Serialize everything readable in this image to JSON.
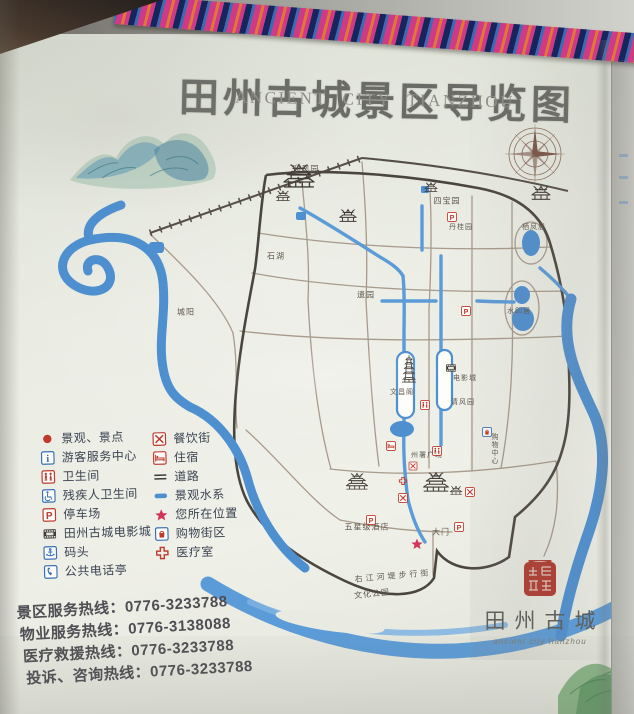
{
  "title": {
    "cn": "田州古城景区导览图",
    "en": "ANCIENT CITY TIANZHOU"
  },
  "seal": {
    "name": "田州古城",
    "script": "ancient city tianzhou"
  },
  "legend": {
    "left": [
      {
        "icon": "spot-dot",
        "label": "景观、景点"
      },
      {
        "icon": "info",
        "label": "游客服务中心"
      },
      {
        "icon": "toilet",
        "label": "卫生间"
      },
      {
        "icon": "accessible-toilet",
        "label": "残疾人卫生间"
      },
      {
        "icon": "parking",
        "label": "停车场"
      },
      {
        "icon": "cinema",
        "label": "田州古城电影城"
      },
      {
        "icon": "dock",
        "label": "码头"
      },
      {
        "icon": "phone",
        "label": "公共电话亭"
      }
    ],
    "right": [
      {
        "icon": "dining",
        "label": "餐饮街"
      },
      {
        "icon": "lodging",
        "label": "住宿"
      },
      {
        "icon": "road",
        "label": "道路"
      },
      {
        "icon": "water",
        "label": "景观水系"
      },
      {
        "icon": "star",
        "label": "您所在位置"
      },
      {
        "icon": "shopping",
        "label": "购物街区"
      },
      {
        "icon": "medical",
        "label": "医疗室"
      }
    ]
  },
  "hotlines": [
    {
      "label": "景区服务热线",
      "number": "0776-3233788"
    },
    {
      "label": "物业服务热线",
      "number": "0776-3138088"
    },
    {
      "label": "医疗救援热线",
      "number": "0776-3233788"
    },
    {
      "label": "投诉、咨询热线",
      "number": "0776-3233788"
    }
  ],
  "map": {
    "labels": [
      {
        "text": "迎凤园",
        "x": 306,
        "y": 169,
        "s": 8
      },
      {
        "text": "四宝园",
        "x": 447,
        "y": 201,
        "s": 8
      },
      {
        "text": "丹桂园",
        "x": 461,
        "y": 227,
        "s": 7
      },
      {
        "text": "栖凤居",
        "x": 534,
        "y": 227,
        "s": 7
      },
      {
        "text": "石湖",
        "x": 276,
        "y": 256,
        "s": 8
      },
      {
        "text": "遗园",
        "x": 366,
        "y": 295,
        "s": 8
      },
      {
        "text": "城阳",
        "x": 186,
        "y": 312,
        "s": 8
      },
      {
        "text": "水印居",
        "x": 519,
        "y": 311,
        "s": 7
      },
      {
        "text": "文昌阁",
        "x": 402,
        "y": 392,
        "s": 7
      },
      {
        "text": "电影城",
        "x": 465,
        "y": 378,
        "s": 7
      },
      {
        "text": "清风园",
        "x": 463,
        "y": 402,
        "s": 7
      },
      {
        "text": "州署广场",
        "x": 427,
        "y": 455,
        "s": 7
      },
      {
        "text": "购物中心",
        "x": 494,
        "y": 449,
        "s": 7,
        "vertical": true
      },
      {
        "text": "五星级酒店",
        "x": 367,
        "y": 527,
        "s": 8
      },
      {
        "text": "大门",
        "x": 441,
        "y": 532,
        "s": 8
      },
      {
        "text": "右江河堤步行街",
        "x": 393,
        "y": 576,
        "s": 8,
        "rotate": -5,
        "ls": 3
      },
      {
        "text": "文化公园",
        "x": 372,
        "y": 594,
        "s": 8,
        "rotate": -6
      }
    ],
    "icons": [
      {
        "t": "parking",
        "x": 452,
        "y": 217,
        "w": 10
      },
      {
        "t": "parking",
        "x": 466,
        "y": 311,
        "w": 10
      },
      {
        "t": "parking",
        "x": 371,
        "y": 520,
        "w": 10
      },
      {
        "t": "parking",
        "x": 459,
        "y": 527,
        "w": 10
      },
      {
        "t": "dining",
        "x": 403,
        "y": 498,
        "w": 10
      },
      {
        "t": "dining",
        "x": 470,
        "y": 492,
        "w": 10
      },
      {
        "t": "dining",
        "x": 413,
        "y": 466,
        "w": 9
      },
      {
        "t": "toilet",
        "x": 425,
        "y": 405,
        "w": 10
      },
      {
        "t": "toilet",
        "x": 437,
        "y": 451,
        "w": 10
      },
      {
        "t": "lodging",
        "x": 391,
        "y": 446,
        "w": 10
      },
      {
        "t": "shopping",
        "x": 487,
        "y": 432,
        "w": 10
      },
      {
        "t": "medical",
        "x": 403,
        "y": 481,
        "w": 9
      },
      {
        "t": "cinema",
        "x": 451,
        "y": 368,
        "w": 11
      },
      {
        "t": "star",
        "x": 417,
        "y": 544,
        "w": 13
      }
    ],
    "buildings": [
      {
        "t": "gate",
        "x": 299,
        "y": 188,
        "w": 34
      },
      {
        "t": "tower",
        "x": 283,
        "y": 201,
        "w": 16
      },
      {
        "t": "tower",
        "x": 348,
        "y": 222,
        "w": 20
      },
      {
        "t": "tower",
        "x": 431,
        "y": 192,
        "w": 15
      },
      {
        "t": "tower",
        "x": 541,
        "y": 200,
        "w": 22
      },
      {
        "t": "pagoda",
        "x": 409,
        "y": 383,
        "w": 17
      },
      {
        "t": "gate",
        "x": 357,
        "y": 490,
        "w": 24
      },
      {
        "t": "gate",
        "x": 436,
        "y": 492,
        "w": 28
      },
      {
        "t": "tower",
        "x": 456,
        "y": 495,
        "w": 14
      }
    ]
  },
  "colors": {
    "river": "#4e8fd0",
    "canal": "#5b9bd8",
    "legend_red": "#c0392b",
    "legend_blue": "#3a6fb5",
    "seal_red": "#b0392e",
    "boundary": "#4a453f",
    "ribbon_pink": "#cf3a86",
    "ribbon_blue": "#3f6ab2",
    "ribbon_orange": "#e0763a"
  }
}
